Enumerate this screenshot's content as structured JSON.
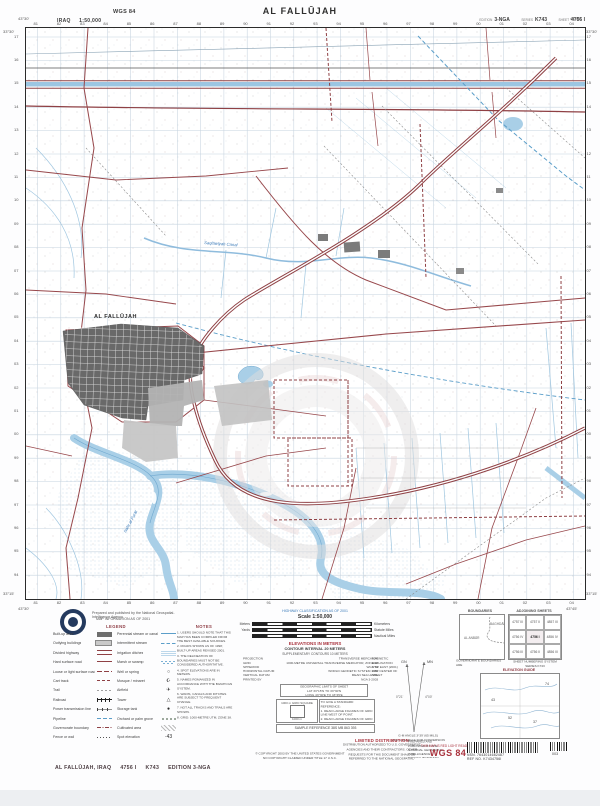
{
  "header": {
    "country": "IRAQ",
    "scale": "1:50,000",
    "datum_badge": "WGS 84",
    "title": "AL FALLŪJAH",
    "edition_label": "EDITION",
    "edition": "3-NGA",
    "series_label": "SERIES",
    "series": "K743",
    "sheet_label": "SHEET",
    "sheet": "4756 I"
  },
  "map": {
    "easting_labels": [
      "81",
      "82",
      "83",
      "84",
      "85",
      "86",
      "87",
      "88",
      "89",
      "90",
      "91",
      "92",
      "93",
      "94",
      "95",
      "96",
      "97",
      "98",
      "99",
      "00",
      "01",
      "02",
      "03",
      "04"
    ],
    "northing_labels": [
      "17",
      "16",
      "15",
      "14",
      "13",
      "12",
      "11",
      "10",
      "09",
      "08",
      "07",
      "06",
      "05",
      "04",
      "03",
      "02",
      "01",
      "00",
      "99",
      "98",
      "97",
      "96",
      "95",
      "94"
    ],
    "corners": {
      "top_left_lon": "43°30'",
      "top_right_lon": "43°45'",
      "bottom_left_lon": "43°30'",
      "bottom_right_lon": "43°45'",
      "top_lat": "33°30'",
      "bottom_lat": "33°15'"
    },
    "labels": [
      {
        "text": "AL FALLŪJAH",
        "x": 68,
        "y": 290,
        "cls": "lbl-city",
        "rot": 0
      },
      {
        "text": "Nahr al Furāt",
        "x": 100,
        "y": 505,
        "cls": "lbl-water",
        "rot": -62
      },
      {
        "text": "Saqlāwīyah Canal",
        "x": 178,
        "y": 216,
        "cls": "lbl-water",
        "rot": 4
      }
    ]
  },
  "prepared_line": "Prepared and published by the National Geospatial-Intelligence Agency",
  "map_info_line": "MAP INFORMATION AS OF 2001",
  "legend": {
    "header": "LEGEND",
    "columns": [
      [
        {
          "label": "Built-up area",
          "sw": "sw-urban"
        },
        {
          "label": "Outlying buildings",
          "sw": "sw-bldg"
        },
        {
          "label": "Divided highway",
          "sw": "sw-hwy"
        },
        {
          "label": "Hard surface road",
          "sw": "sw-road"
        },
        {
          "label": "Loose or light surface road",
          "sw": "sw-road2"
        },
        {
          "label": "Cart track",
          "sw": "sw-track"
        },
        {
          "label": "Trail",
          "sw": "sw-trail"
        },
        {
          "label": "Railroad",
          "sw": "sw-rail"
        },
        {
          "label": "Power transmission line",
          "sw": "sw-power"
        },
        {
          "label": "Pipeline",
          "sw": "sw-pipe"
        },
        {
          "label": "Governorate boundary",
          "sw": "sw-bdy"
        },
        {
          "label": "Fence or wall",
          "sw": "sw-fence"
        }
      ],
      [
        {
          "label": "Perennial stream or canal",
          "sw": "sw-canal"
        },
        {
          "label": "Intermittent stream",
          "sw": "sw-stream"
        },
        {
          "label": "Irrigation ditches",
          "sw": "sw-ditch"
        },
        {
          "label": "Marsh or swamp",
          "sw": "sw-marsh"
        },
        {
          "label": "Well or spring",
          "sw": "sw-sym",
          "glyph": "○"
        },
        {
          "label": "Mosque / minaret",
          "sw": "sw-sym",
          "glyph": "☪"
        },
        {
          "label": "Airfield",
          "sw": "sw-sym",
          "glyph": "✈"
        },
        {
          "label": "Tower",
          "sw": "sw-sym",
          "glyph": "△"
        },
        {
          "label": "Storage tank",
          "sw": "sw-sym",
          "glyph": "●"
        },
        {
          "label": "Orchard or palm grove",
          "sw": "sw-orch"
        },
        {
          "label": "Cultivated area",
          "sw": "sw-cult"
        },
        {
          "label": "Spot elevation",
          "sw": "sw-sym",
          "glyph": "·43"
        }
      ]
    ]
  },
  "notes": {
    "header": "NOTES",
    "lines": [
      "1. USERS SHOULD NOTE THAT THIS MAP HAS BEEN COMPILED FROM THE BEST AVAILABLE SOURCES.",
      "2. ROADS SHOWN AS OF 1998; BUILT-UP AREAS REVISED 2001.",
      "3. THE DELINEATION OF BOUNDARIES MUST NOT BE CONSIDERED AUTHORITATIVE.",
      "4. SPOT ELEVATIONS ARE IN METERS.",
      "5. NAMES ROMANIZED IN ACCORDANCE WITH THE BGN/PCGN SYSTEM.",
      "6. WADIS, CANALS AND DITCHES ARE SUBJECT TO FREQUENT CHANGE.",
      "7. NOT ALL TRACKS AND TRAILS ARE SHOWN.",
      "8. GRID: 1000-METRE UTM, ZONE 38."
    ]
  },
  "scale_block": {
    "note": "HIGHWAY CLASSIFICATION AS OF 2001",
    "title": "Scale 1:50,000",
    "bars": [
      {
        "left": "Meters",
        "right": "Kilometers"
      },
      {
        "left": "Yards",
        "right": "Statute Miles"
      },
      {
        "left": "",
        "right": "Nautical Miles"
      }
    ],
    "elev_title": "ELEVATIONS IN METERS",
    "contour": "CONTOUR INTERVAL 20 METERS",
    "supplementary": "SUPPLEMENTARY CONTOURS 10 METERS"
  },
  "datum_block": {
    "rows": [
      {
        "label": "PROJECTION",
        "value": "TRANSVERSE MERCATOR"
      },
      {
        "label": "GRID",
        "value": "1000-METRE UNIVERSAL TRANSVERSE MERCATOR, ZONE 38"
      },
      {
        "label": "SPHEROID",
        "value": "WGS 84"
      },
      {
        "label": "HORIZONTAL DATUM",
        "value": "WORLD GEODETIC SYSTEM 1984"
      },
      {
        "label": "VERTICAL DATUM",
        "value": "MEAN SEA LEVEL"
      },
      {
        "label": "PRINTED BY",
        "value": "NGA 3-2003"
      }
    ],
    "side_lines": [
      "MAGNETIC DECLINATION",
      "4°00' EAST (2001)",
      "FOR CENTER OF SHEET"
    ]
  },
  "geo_box_lines": [
    "GEOGRAPHIC LIMITS OF SHEET",
    "LAT 33°15'N TO 33°30'N",
    "LONG 43°30'E TO 43°45'E"
  ],
  "dim_box": {
    "title": "1000 m GRID SQUARE",
    "side": "1000 m"
  },
  "ref_box_lines": [
    "TO GIVE A STANDARD REFERENCE:",
    "1. READ LARGE FIGURES OF GRID LINE WEST OF POINT.",
    "2. READ LARGE FIGURES OF GRID LINE SOUTH OF POINT.",
    "SAMPLE REFERENCE: 38S MB 863 393"
  ],
  "sample_ref_line": "SAMPLE REFERENCE  38S MB 863 393",
  "declination": {
    "gn": "GN",
    "mn": "MN",
    "gn_val": "0°21'",
    "mn_val": "4°00'",
    "caption": [
      "G-M ANGLE 3°39' (65 MILS)",
      "USE G-M ANGLE FOR CONVERSION"
    ]
  },
  "boundaries": {
    "header": "BOUNDARIES",
    "left_label": "AL ANBĀR",
    "right_label": "BAGHDĀD",
    "caption": [
      "GOVERNORATE BOUNDARIES ARE",
      "APPROXIMATE"
    ]
  },
  "adjoining": {
    "header": "ADJOINING SHEETS",
    "cells": [
      "4757 III",
      "4757 II",
      "4857 III",
      "4756 IV",
      "4756 I",
      "4856 IV",
      "4756 III",
      "4756 II",
      "4856 III"
    ],
    "caption": [
      "SHEET NUMBERING SYSTEM",
      "SERIES K743"
    ]
  },
  "elevation_guide": {
    "header": "ELEVATION GUIDE",
    "spots": [
      {
        "v": "74",
        "x": 64,
        "y": 8
      },
      {
        "v": "43",
        "x": 10,
        "y": 24
      },
      {
        "v": "52",
        "x": 27,
        "y": 42
      },
      {
        "v": "37",
        "x": 52,
        "y": 46
      }
    ]
  },
  "distribution": {
    "header": "LIMITED DISTRIBUTION",
    "lines": [
      "DISTRIBUTION AUTHORIZED TO U.S. GOVERNMENT",
      "AGENCIES AND THEIR CONTRACTORS. OTHER",
      "REQUESTS FOR THIS DOCUMENT SHALL BE",
      "REFERRED TO THE NATIONAL GEOSPATIAL-",
      "INTELLIGENCE AGENCY. DESTROY BY SHREDDING",
      "OR BURNING TO PREVENT DISCLOSURE."
    ]
  },
  "production_note_lines": [
    "PREPARED AND PUBLISHED BY THE",
    "NATIONAL GEOSPATIAL-INTELLIGENCE",
    "AGENCY, BETHESDA, MD. FOR THE",
    "DEPARTMENT OF DEFENSE.",
    "PRINTED 10-03."
  ],
  "copyright_lines": [
    "© COPYRIGHT 2003 BY THE UNITED STATES GOVERNMENT",
    "NO COPYRIGHT CLAIMED UNDER TITLE 17 U.S.C."
  ],
  "red_light_line": "THIS MAP IS RED LIGHT READABLE",
  "wgs_large": "WGS 84",
  "barcodes": {
    "left_lines": [
      "NSN. 7643014682487",
      "REF NO. K7434756I"
    ],
    "right_label": "003"
  },
  "footer": {
    "name": "AL FALLŪJAH, IRAQ",
    "sheet": "4756 I",
    "series": "K743",
    "edition": "EDITION 3-NGA"
  }
}
